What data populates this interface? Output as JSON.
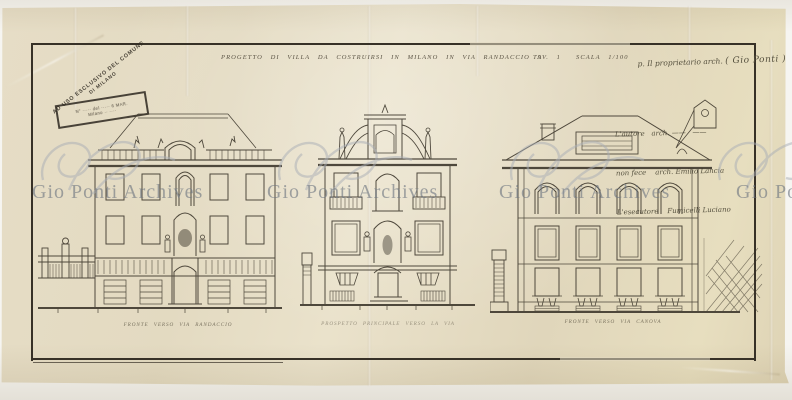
{
  "document": {
    "kind": "scanned architectural drawing",
    "paper_color": "#e3dac1",
    "ink_color": "#3b352b"
  },
  "header": {
    "title": "PROGETTO DI VILLA DA COSTRUIRSI IN MILANO IN VIA RANDACCIO 9",
    "sheet_label": "TAV. 1",
    "scale_label": "SCALA 1/100"
  },
  "stamp": {
    "arc_line1": "AD USO ESCLUSIVO DEL COMUNE",
    "arc_line2": "DI MILANO",
    "box_line1": "N° ····· del ····· 6 MAR.",
    "box_line2": "Milano ·· ····"
  },
  "annotations": {
    "proprietor": "p. Il proprietario arch. ",
    "proprietor_signature": "( Gio Ponti )",
    "right_lines": [
      "L'autore   arch. ——   ——",
      "non fece    arch. Emilio Lancia",
      "L'esecutore    Fumicelli Luciano"
    ]
  },
  "elevations": [
    {
      "caption": "FRONTE VERSO VIA RANDACCIO"
    },
    {
      "caption": "PROSPETTO PRINCIPALE VERSO LA VIA"
    },
    {
      "caption": "FRONTE VERSO VIA CANOVA"
    }
  ],
  "watermark": {
    "text": "Gio Ponti Archives",
    "color": "#6c7480"
  }
}
